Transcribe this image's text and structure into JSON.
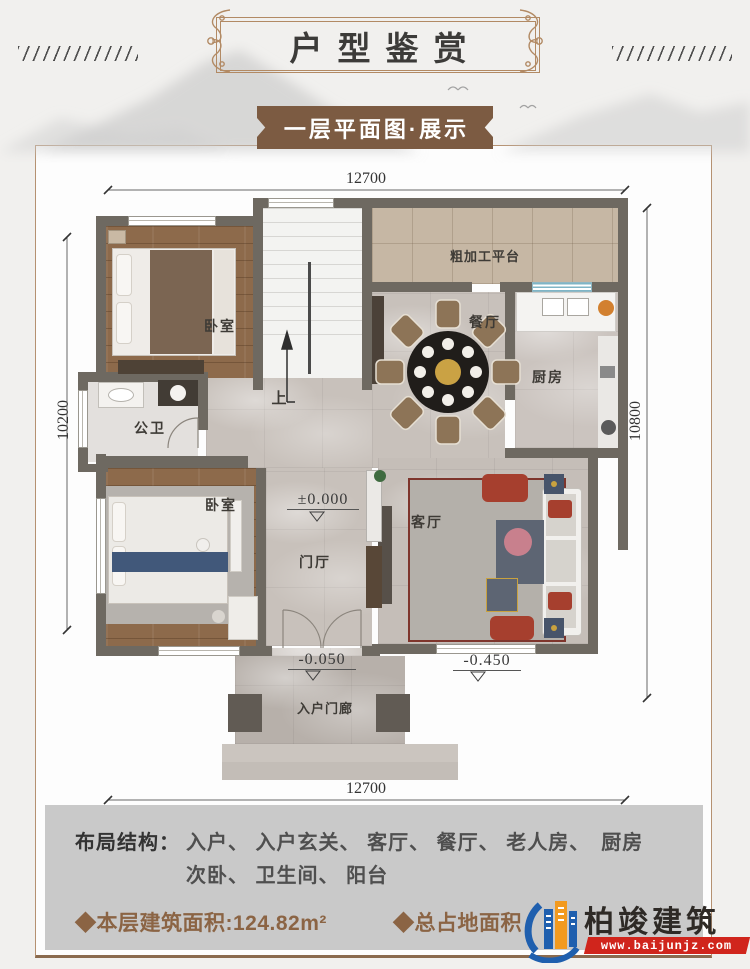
{
  "page": {
    "title": "户型鉴赏",
    "subtitle": "一层平面图·展示"
  },
  "plan": {
    "dimensions": {
      "top": "12700",
      "bottom": "12700",
      "left": "10200",
      "right": "10800"
    },
    "rooms": {
      "bedroom_top": "卧室",
      "bedroom_bottom": "卧室",
      "bathroom": "公卫",
      "dining": "餐厅",
      "kitchen": "厨房",
      "living": "客厅",
      "foyer": "门厅",
      "porch": "入户门廊",
      "platform": "粗加工平台",
      "stairs_up": "上"
    },
    "elevations": {
      "foyer": "±0.000",
      "porch": "-0.050",
      "outside_living": "-0.450"
    }
  },
  "info": {
    "layout_label": "布局结构：",
    "layout_line1": "入户、 入户玄关、 客厅、 餐厅、 老人房、　厨房",
    "layout_line2": "次卧、 卫生间、 阳台",
    "floor_area": "◆本层建筑面积:124.82m²",
    "total_area_label": "◆总占地面积"
  },
  "logo": {
    "name": "柏竣建筑",
    "url": "www.baijunjz.com"
  },
  "colors": {
    "banner_brown": "#7c5b42",
    "frame_bronze": "#b28a64",
    "wall": "#6e6961",
    "info_text_brown": "#8b6444",
    "logo_red": "#d0251c",
    "logo_blue": "#1f5fae",
    "logo_orange": "#f29a1f",
    "info_panel_gray": "#c9c9c9"
  }
}
